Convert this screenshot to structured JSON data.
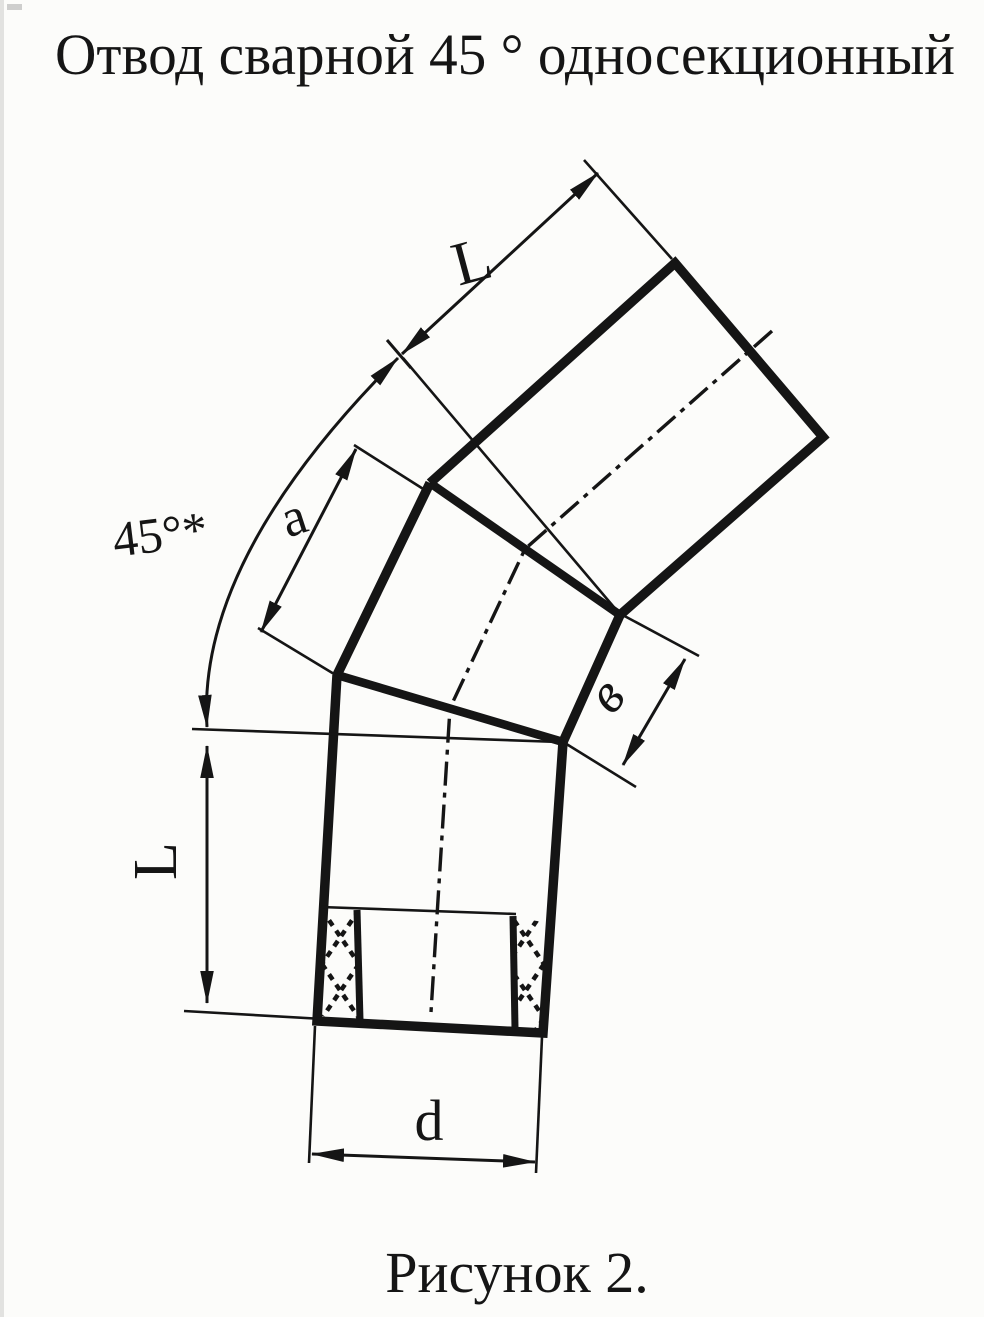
{
  "title": "Отвод сварной 45 ° односекционный",
  "caption": "Рисунок 2.",
  "dimensions": {
    "upper_length": "L",
    "section_outer": "a",
    "bend_angle": "45°*",
    "section_inner": "в",
    "lower_length": "L",
    "diameter": "d"
  },
  "colors": {
    "ink": "#151515",
    "paper": "#fcfcfa"
  }
}
